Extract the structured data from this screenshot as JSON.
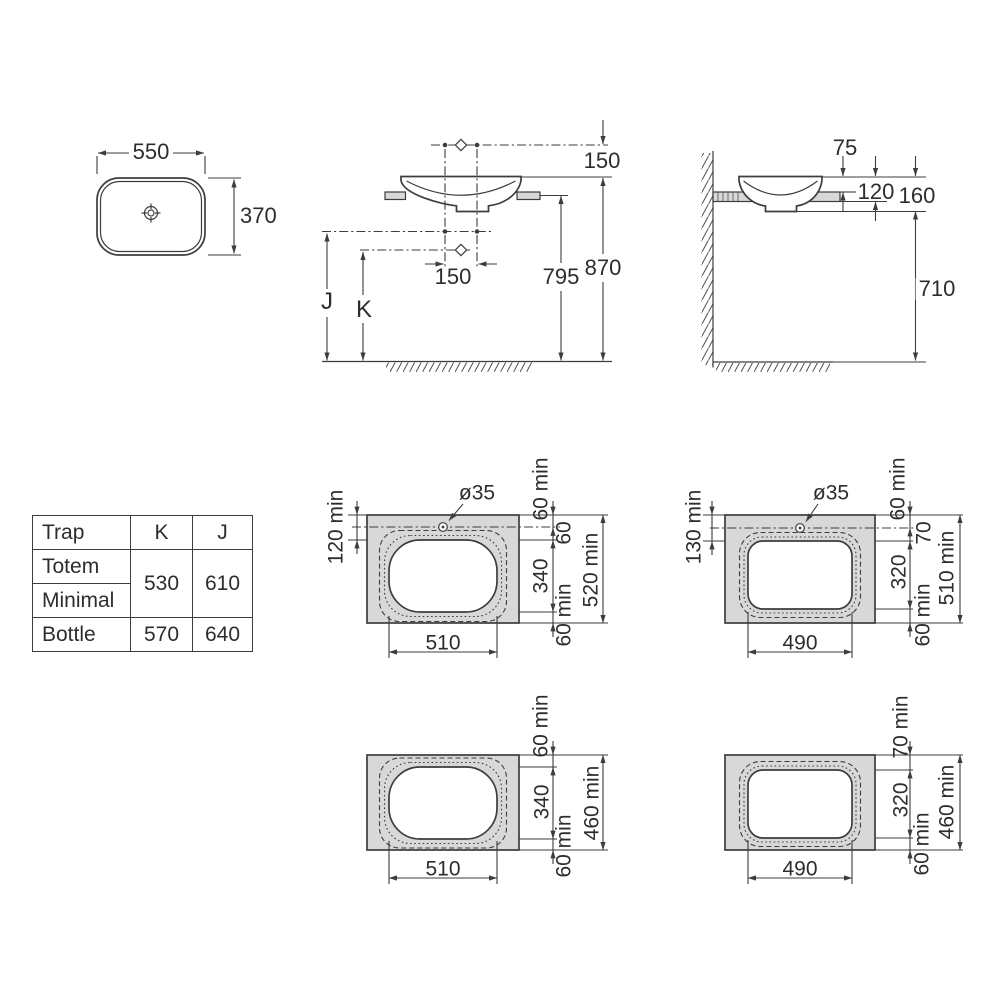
{
  "top_view": {
    "width": "550",
    "depth": "370"
  },
  "front_view": {
    "faucet_above_rim": "150",
    "faucet_spacing": "150",
    "floor_to_counter": "795",
    "floor_to_rim": "870",
    "trap_j": "J",
    "trap_k": "K"
  },
  "side_view": {
    "rim_above_counter": "75",
    "rim_to_counter_underside": "120",
    "rim_to_basin_bottom": "160",
    "basin_bottom_to_floor": "710"
  },
  "trap_table": {
    "col_trap": "Trap",
    "col_k": "K",
    "col_j": "J",
    "row_totem": "Totem",
    "row_minimal": "Minimal",
    "row_bottle": "Bottle",
    "totem_minimal_k": "530",
    "totem_minimal_j": "610",
    "bottle_k": "570",
    "bottle_j": "640"
  },
  "cutout_oval_tap": {
    "hole_dia": "ø35",
    "front_margin": "120 min",
    "edge_to_tap": "60 min",
    "tap_to_cutout": "60",
    "cutout_depth": "340",
    "back_margin": "60 min",
    "min_total_depth": "520 min",
    "cutout_width": "510"
  },
  "cutout_rect_tap": {
    "hole_dia": "ø35",
    "front_margin": "130 min",
    "edge_to_tap": "60 min",
    "tap_to_cutout": "70",
    "cutout_depth": "320",
    "back_margin": "60 min",
    "min_total_depth": "510 min",
    "cutout_width": "490"
  },
  "cutout_oval_plain": {
    "edge_margin": "60 min",
    "cutout_depth": "340",
    "back_margin": "60 min",
    "min_total_depth": "460 min",
    "cutout_width": "510"
  },
  "cutout_rect_plain": {
    "edge_margin": "70 min",
    "cutout_depth": "320",
    "back_margin": "60 min",
    "min_total_depth": "460 min",
    "cutout_width": "490"
  },
  "colors": {
    "line": "#3d3d3d",
    "counter_fill": "#d8d8d8",
    "text": "#2d2d2d"
  }
}
